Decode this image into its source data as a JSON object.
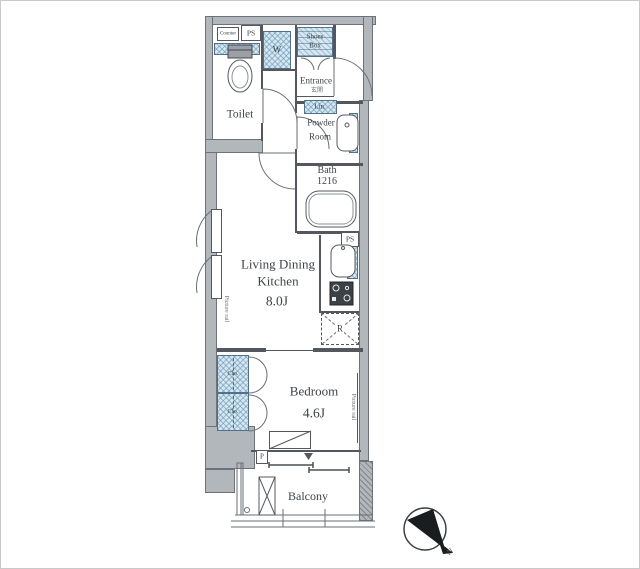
{
  "plan_title": "apartment-floor-plan",
  "rooms": {
    "toilet": {
      "label": "Toilet"
    },
    "entrance": {
      "label": "Entrance",
      "step_note": "玄関"
    },
    "powder_room": {
      "line1": "Powder",
      "line2": "Room"
    },
    "bath": {
      "line1": "Bath",
      "line2": "1216"
    },
    "ldk": {
      "line1": "Living Dining",
      "line2": "Kitchen",
      "size": "8.0J"
    },
    "bedroom": {
      "label": "Bedroom",
      "size": "4.6J"
    },
    "balcony": {
      "label": "Balcony"
    }
  },
  "fixtures": {
    "counter": {
      "label": "Counter"
    },
    "ps_toilet": {
      "label": "PS"
    },
    "ps_kitchen": {
      "label": "PS"
    },
    "washer": {
      "label": "W"
    },
    "shoes_box": {
      "line1": "Shoes",
      "line2": "Box"
    },
    "linen": {
      "label": "Lin."
    },
    "closet_upper": {
      "label": "Clo."
    },
    "closet_lower": {
      "label": "Clo."
    },
    "refrigerator": {
      "label": "R"
    },
    "pipe": {
      "label": "P"
    },
    "picture_rail_ldk": {
      "label": "Picture rail"
    },
    "picture_rail_bedroom": {
      "label": "Picture rail"
    }
  },
  "compass": {
    "label": "N"
  },
  "colors": {
    "wall_gray": "#b2b7bc",
    "fixture_blue": "#d6e7f1",
    "line_dark": "#54585e"
  }
}
